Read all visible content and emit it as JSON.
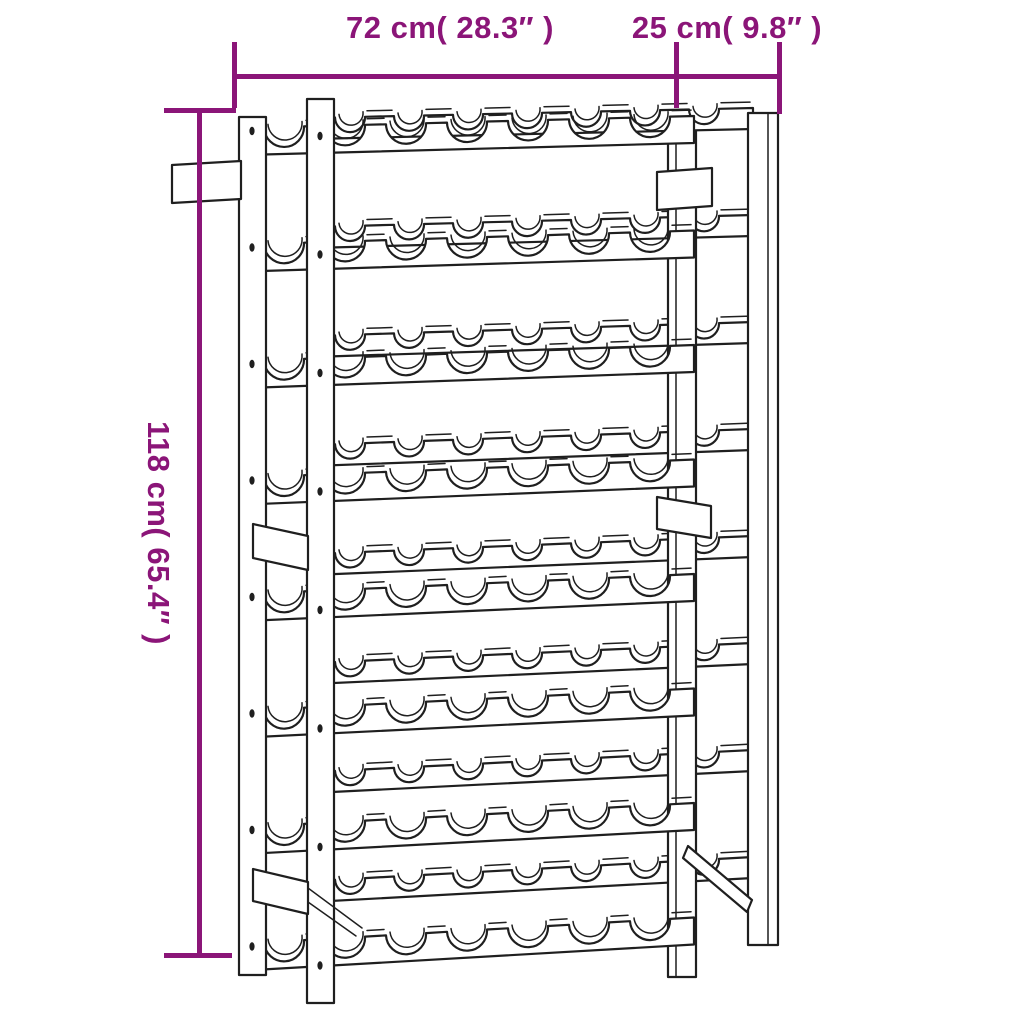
{
  "dimensions": {
    "width_label": "72 cm( 28.3″ )",
    "depth_label": "25 cm( 9.8″ )",
    "height_label": "118 cm( 65.4″ )"
  },
  "colors": {
    "dimension_annotation": "#8B1578",
    "line_art": "#1f1f1f",
    "background": "#ffffff"
  },
  "rack": {
    "shelf_rows": 8,
    "bottle_slots_per_row": 7
  }
}
